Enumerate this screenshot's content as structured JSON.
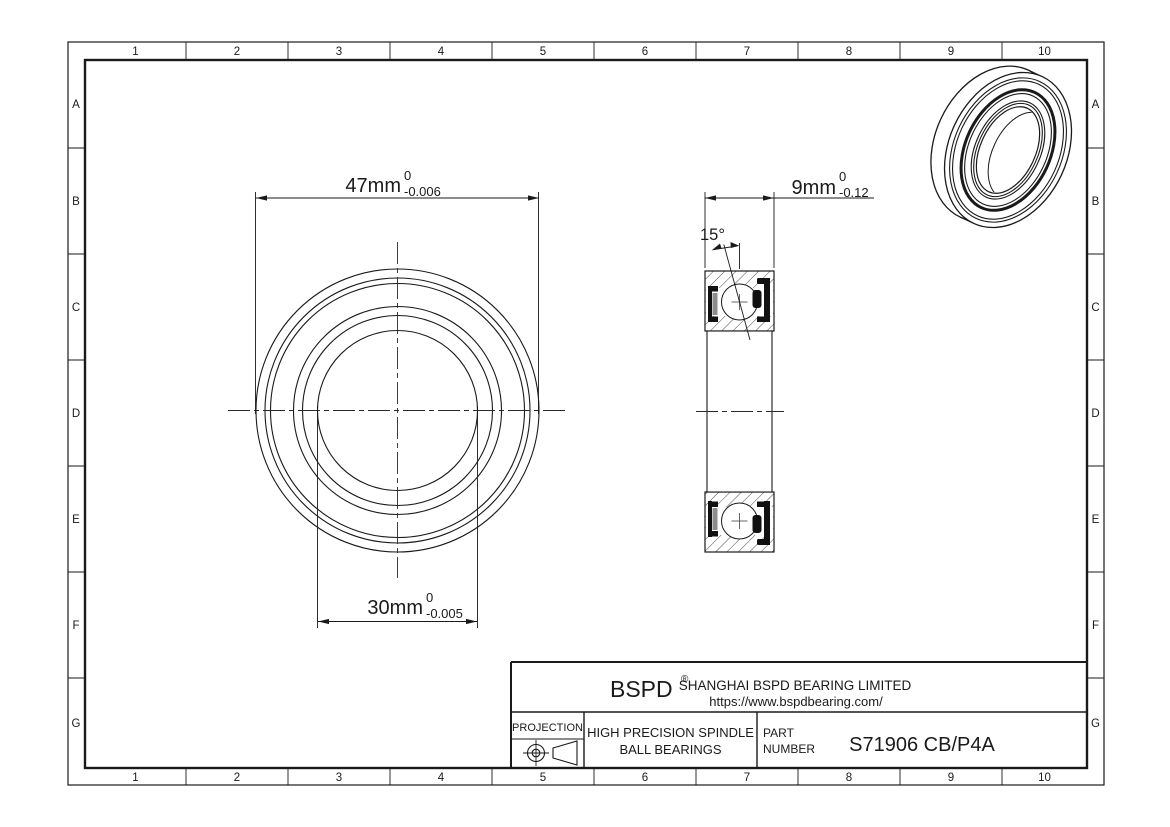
{
  "sheet": {
    "grid_columns": [
      "1",
      "2",
      "3",
      "4",
      "5",
      "6",
      "7",
      "8",
      "9",
      "10"
    ],
    "grid_rows": [
      "A",
      "B",
      "C",
      "D",
      "E",
      "F",
      "G"
    ]
  },
  "dimensions": {
    "outer_diameter": {
      "value": "47mm",
      "upper_tol": "0",
      "lower_tol": "-0.006"
    },
    "bore_diameter": {
      "value": "30mm",
      "upper_tol": "0",
      "lower_tol": "-0.005"
    },
    "width": {
      "value": "9mm",
      "upper_tol": "0",
      "lower_tol": "-0.12"
    },
    "contact_angle": "15°"
  },
  "title_block": {
    "brand": "BSPD",
    "brand_mark": "®",
    "company": "SHANGHAI BSPD BEARING LIMITED",
    "website": "https://www.bspdbearing.com/",
    "projection_label": "PROJECTION",
    "product_line1": "HIGH  PRECISION SPINDLE",
    "product_line2": "BALL BEARINGS",
    "part_label_line1": "PART",
    "part_label_line2": "NUMBER",
    "part_number": "S71906 CB/P4A"
  }
}
